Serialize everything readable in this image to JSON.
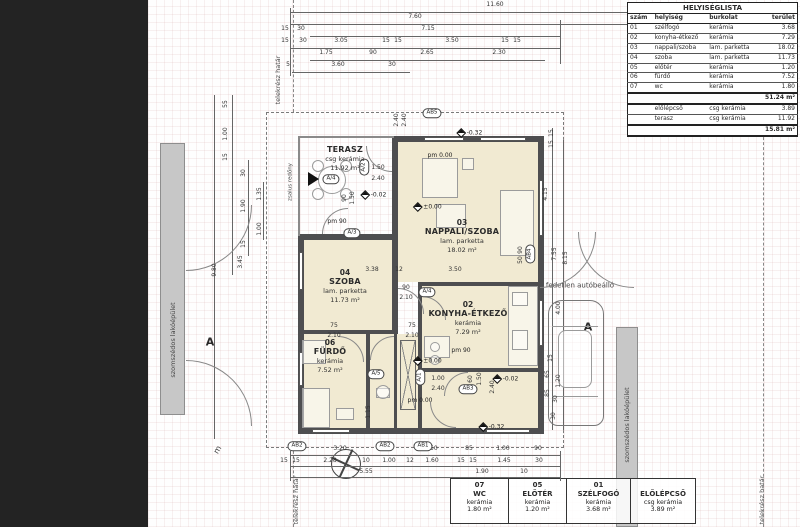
{
  "legend": {
    "title": "HELYISÉGLISTA",
    "headers": [
      "szám",
      "helyiség",
      "burkolat",
      "terület"
    ],
    "rows": [
      [
        "01",
        "szélfogó",
        "kerámia",
        "3.68"
      ],
      [
        "02",
        "konyha-étkező",
        "kerámia",
        "7.29"
      ],
      [
        "03",
        "nappali/szoba",
        "lam. parketta",
        "18.02"
      ],
      [
        "04",
        "szoba",
        "lam. parketta",
        "11.73"
      ],
      [
        "05",
        "előtér",
        "kerámia",
        "1.20"
      ],
      [
        "06",
        "fürdő",
        "kerámia",
        "7.52"
      ],
      [
        "07",
        "wc",
        "kerámia",
        "1.80"
      ]
    ],
    "subtotal": "51.24 m²",
    "extra_rows": [
      [
        "",
        "előlépcső",
        "csg kerámia",
        "3.89"
      ],
      [
        "",
        "terasz",
        "csg kerámia",
        "11.92"
      ]
    ],
    "total": "15.81 m²"
  },
  "rooms": [
    {
      "num": "03",
      "name": "NAPPALI/SZOBA",
      "material": "lam. parketta",
      "area": "18.02 m²",
      "x": 462,
      "y": 218
    },
    {
      "num": "04",
      "name": "SZOBA",
      "material": "lam. parketta",
      "area": "11.73 m²",
      "x": 345,
      "y": 268
    },
    {
      "num": "06",
      "name": "FÜRDŐ",
      "material": "kerámia",
      "area": "7.52 m²",
      "x": 330,
      "y": 338
    },
    {
      "num": "02",
      "name": "KONYHA-ÉTKEZŐ",
      "material": "kerámia",
      "area": "7.29 m²",
      "x": 468,
      "y": 300
    }
  ],
  "terrace": {
    "name": "TERASZ",
    "material": "csg kerámia",
    "area": "11.92 m²",
    "x": 345,
    "y": 145
  },
  "callouts": [
    {
      "num": "07",
      "name": "WC",
      "material": "kerámia",
      "area": "1.80 m²",
      "w": 58
    },
    {
      "num": "05",
      "name": "ELŐTÉR",
      "material": "kerámia",
      "area": "1.20 m²",
      "w": 58
    },
    {
      "num": "01",
      "name": "SZÉLFOGÓ",
      "material": "kerámia",
      "area": "3.68 m²",
      "w": 64
    },
    {
      "num": "",
      "name": "ELŐLÉPCSŐ",
      "material": "csg kerámia",
      "area": "3.89 m²",
      "w": 64
    }
  ],
  "site": {
    "neighbor": "szomszédos lakóépület",
    "carport": "fedetlen autóbeálló",
    "boundary": "telekrész határ",
    "electric": "villanyóra",
    "ac1": "fali kültéri egység",
    "ac2": "split klíma",
    "shutter": "zsalus redőny",
    "north": "m",
    "section": "A"
  },
  "dims": [
    {
      "t": "11.60",
      "x": 495,
      "y": 5
    },
    {
      "t": "7.60",
      "x": 415,
      "y": 17
    },
    {
      "t": "4.00",
      "x": 636,
      "y": 17
    },
    {
      "t": "15",
      "x": 285,
      "y": 29
    },
    {
      "t": "30",
      "x": 301,
      "y": 29
    },
    {
      "t": "7.15",
      "x": 428,
      "y": 29
    },
    {
      "t": "15",
      "x": 285,
      "y": 41
    },
    {
      "t": "30",
      "x": 303,
      "y": 41
    },
    {
      "t": "3.05",
      "x": 341,
      "y": 41
    },
    {
      "t": "15",
      "x": 386,
      "y": 41
    },
    {
      "t": "15",
      "x": 398,
      "y": 41
    },
    {
      "t": "3.50",
      "x": 452,
      "y": 41
    },
    {
      "t": "15",
      "x": 505,
      "y": 41
    },
    {
      "t": "15",
      "x": 517,
      "y": 41
    },
    {
      "t": "1.75",
      "x": 326,
      "y": 53
    },
    {
      "t": "90",
      "x": 373,
      "y": 53
    },
    {
      "t": "2.65",
      "x": 427,
      "y": 53
    },
    {
      "t": "2.30",
      "x": 499,
      "y": 53
    },
    {
      "t": "5",
      "x": 288,
      "y": 65
    },
    {
      "t": "3.60",
      "x": 338,
      "y": 65
    },
    {
      "t": "30",
      "x": 392,
      "y": 65
    },
    {
      "t": "2.40",
      "x": 397,
      "y": 120,
      "r": 1
    },
    {
      "t": "2.40",
      "x": 405,
      "y": 120,
      "r": 1
    },
    {
      "t": "55",
      "x": 226,
      "y": 104,
      "r": 1
    },
    {
      "t": "1.00",
      "x": 226,
      "y": 134,
      "r": 1
    },
    {
      "t": "15",
      "x": 226,
      "y": 157,
      "r": 1
    },
    {
      "t": "30",
      "x": 244,
      "y": 173,
      "r": 1
    },
    {
      "t": "1.90",
      "x": 244,
      "y": 206,
      "r": 1
    },
    {
      "t": "15",
      "x": 244,
      "y": 244,
      "r": 1
    },
    {
      "t": "1.35",
      "x": 260,
      "y": 194,
      "r": 1
    },
    {
      "t": "1.00",
      "x": 260,
      "y": 229,
      "r": 1
    },
    {
      "t": "3.45",
      "x": 241,
      "y": 262,
      "r": 1
    },
    {
      "t": "9.80",
      "x": 215,
      "y": 270,
      "r": 1
    },
    {
      "t": "15",
      "x": 552,
      "y": 133,
      "r": 1
    },
    {
      "t": "15",
      "x": 552,
      "y": 144,
      "r": 1
    },
    {
      "t": "4.15",
      "x": 546,
      "y": 194,
      "r": 1
    },
    {
      "t": "7.55",
      "x": 555,
      "y": 254,
      "r": 1
    },
    {
      "t": "8.15",
      "x": 566,
      "y": 258,
      "r": 1
    },
    {
      "t": "4.00",
      "x": 559,
      "y": 308,
      "r": 1
    },
    {
      "t": "15",
      "x": 551,
      "y": 358,
      "r": 1
    },
    {
      "t": "65",
      "x": 548,
      "y": 374,
      "r": 1
    },
    {
      "t": "85",
      "x": 548,
      "y": 393,
      "r": 1
    },
    {
      "t": "1.20",
      "x": 559,
      "y": 381,
      "r": 1
    },
    {
      "t": "30",
      "x": 556,
      "y": 399,
      "r": 1
    },
    {
      "t": "30",
      "x": 554,
      "y": 416,
      "r": 1
    },
    {
      "t": "1.50",
      "x": 378,
      "y": 168
    },
    {
      "t": "2.40",
      "x": 378,
      "y": 179
    },
    {
      "t": "90",
      "x": 345,
      "y": 198,
      "r": 1
    },
    {
      "t": "1.50",
      "x": 353,
      "y": 198,
      "r": 1
    },
    {
      "t": "90",
      "x": 406,
      "y": 288
    },
    {
      "t": "2.10",
      "x": 406,
      "y": 298
    },
    {
      "t": "75",
      "x": 334,
      "y": 326
    },
    {
      "t": "2.10",
      "x": 334,
      "y": 336
    },
    {
      "t": "75",
      "x": 412,
      "y": 326
    },
    {
      "t": "2.10",
      "x": 412,
      "y": 336
    },
    {
      "t": "1.00",
      "x": 438,
      "y": 379
    },
    {
      "t": "2.40",
      "x": 438,
      "y": 389
    },
    {
      "t": "60",
      "x": 471,
      "y": 379,
      "r": 1
    },
    {
      "t": "1.50",
      "x": 480,
      "y": 379,
      "r": 1
    },
    {
      "t": "2.40",
      "x": 493,
      "y": 387,
      "r": 1
    },
    {
      "t": "90",
      "x": 521,
      "y": 250,
      "r": 1
    },
    {
      "t": "50",
      "x": 521,
      "y": 260,
      "r": 1
    },
    {
      "t": "1.15",
      "x": 369,
      "y": 412,
      "r": 1
    },
    {
      "t": "3.38",
      "x": 372,
      "y": 270
    },
    {
      "t": "12",
      "x": 399,
      "y": 270
    },
    {
      "t": "3.50",
      "x": 455,
      "y": 270
    },
    {
      "t": "3.20",
      "x": 340,
      "y": 449
    },
    {
      "t": "1.50",
      "x": 431,
      "y": 449
    },
    {
      "t": "85",
      "x": 469,
      "y": 449
    },
    {
      "t": "1.00",
      "x": 503,
      "y": 449
    },
    {
      "t": "90",
      "x": 538,
      "y": 449
    },
    {
      "t": "15",
      "x": 284,
      "y": 461
    },
    {
      "t": "15",
      "x": 296,
      "y": 461
    },
    {
      "t": "2.28",
      "x": 330,
      "y": 461
    },
    {
      "t": "10",
      "x": 366,
      "y": 461
    },
    {
      "t": "1.00",
      "x": 389,
      "y": 461
    },
    {
      "t": "12",
      "x": 410,
      "y": 461
    },
    {
      "t": "1.60",
      "x": 432,
      "y": 461
    },
    {
      "t": "15",
      "x": 461,
      "y": 461
    },
    {
      "t": "15",
      "x": 473,
      "y": 461
    },
    {
      "t": "1.45",
      "x": 504,
      "y": 461
    },
    {
      "t": "30",
      "x": 539,
      "y": 461
    },
    {
      "t": "5.55",
      "x": 366,
      "y": 472
    },
    {
      "t": "1.90",
      "x": 482,
      "y": 472
    },
    {
      "t": "10",
      "x": 524,
      "y": 472
    }
  ],
  "levels": [
    {
      "t": "pm 0.00",
      "x": 440,
      "y": 156
    },
    {
      "t": "±0.00",
      "x": 428,
      "y": 207,
      "d": 1
    },
    {
      "t": "-0.32",
      "x": 470,
      "y": 133,
      "d": 1
    },
    {
      "t": "-0.02",
      "x": 374,
      "y": 195,
      "d": 1
    },
    {
      "t": "pm 90",
      "x": 337,
      "y": 222
    },
    {
      "t": "pm 90",
      "x": 461,
      "y": 351
    },
    {
      "t": "±0.00",
      "x": 428,
      "y": 361,
      "d": 1
    },
    {
      "t": "pm 0.00",
      "x": 420,
      "y": 401
    },
    {
      "t": "-0.02",
      "x": 506,
      "y": 379,
      "d": 1
    },
    {
      "t": "-0.32",
      "x": 492,
      "y": 427,
      "d": 1
    }
  ],
  "markers": [
    {
      "t": "A/4",
      "x": 331,
      "y": 179
    },
    {
      "t": "A/2",
      "x": 364,
      "y": 167,
      "v": 1
    },
    {
      "t": "A/3",
      "x": 352,
      "y": 233
    },
    {
      "t": "A/4",
      "x": 427,
      "y": 292
    },
    {
      "t": "A/5",
      "x": 376,
      "y": 374
    },
    {
      "t": "A/1",
      "x": 420,
      "y": 377,
      "v": 1
    },
    {
      "t": "AB5",
      "x": 432,
      "y": 113
    },
    {
      "t": "AB4",
      "x": 530,
      "y": 254,
      "v": 1
    },
    {
      "t": "AB3",
      "x": 468,
      "y": 389
    },
    {
      "t": "AB2",
      "x": 297,
      "y": 446
    },
    {
      "t": "AB2",
      "x": 385,
      "y": 446
    },
    {
      "t": "AB1",
      "x": 423,
      "y": 446
    }
  ]
}
